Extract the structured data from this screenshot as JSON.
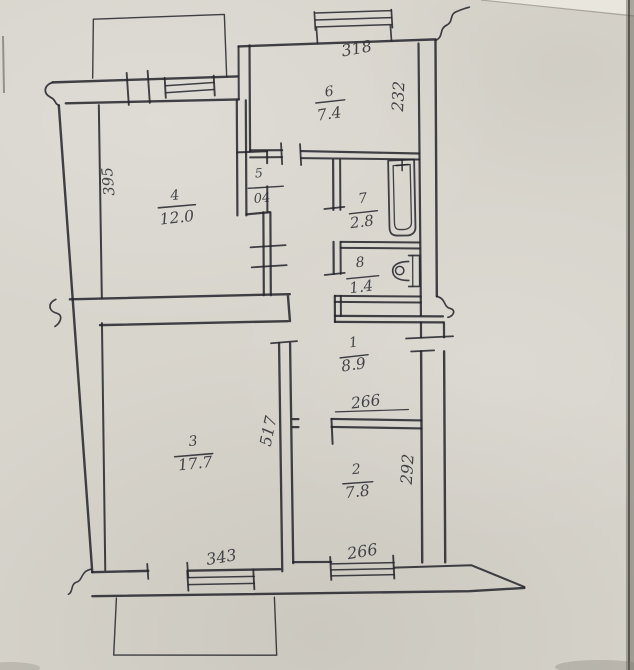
{
  "document": {
    "kind": "scanned hand-drawn apartment floor plan"
  },
  "colors": {
    "ink": "#23232a",
    "paper": "#d8d5cd"
  },
  "rooms": {
    "kitchen": {
      "number": "6",
      "area": "7.4"
    },
    "room4": {
      "number": "4",
      "area": "12.0"
    },
    "closet": {
      "number": "5",
      "area": "04"
    },
    "bath": {
      "number": "7",
      "area": "2.8"
    },
    "wc": {
      "number": "8",
      "area": "1.4"
    },
    "hall": {
      "number": "1",
      "area": "8.9"
    },
    "living": {
      "number": "3",
      "area": "17.7"
    },
    "room2": {
      "number": "2",
      "area": "7.8"
    }
  },
  "dimensions": {
    "kitchen_width": "318",
    "kitchen_depth": "232",
    "room4_depth": "395",
    "hall_width": "266",
    "room2_depth": "292",
    "room2_width": "266",
    "living_depth": "517",
    "living_width": "343"
  }
}
